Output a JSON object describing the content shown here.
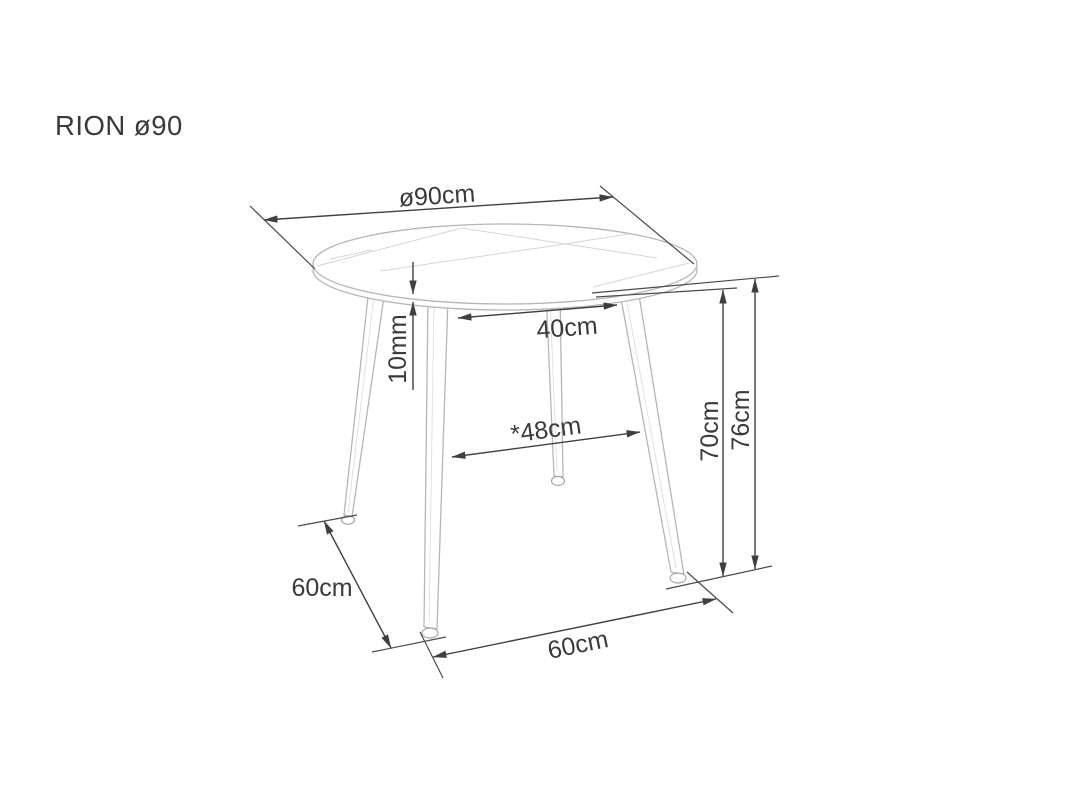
{
  "title": "RION ø90",
  "diagram": {
    "product_name": "RION ø90",
    "dimensions": {
      "tabletop_diameter": "ø90cm",
      "tabletop_thickness": "10mm",
      "leg_spacing_top": "40cm",
      "leg_spacing_mid": "*48cm",
      "height_to_underside": "70cm",
      "total_height": "76cm",
      "foot_spacing_side": "60cm",
      "foot_spacing_front": "60cm"
    }
  },
  "colors": {
    "background": "#ffffff",
    "dimension_lines": "#3f3f3f",
    "label_text": "#3a3a3a",
    "table_outline": "#b3b7b7"
  }
}
